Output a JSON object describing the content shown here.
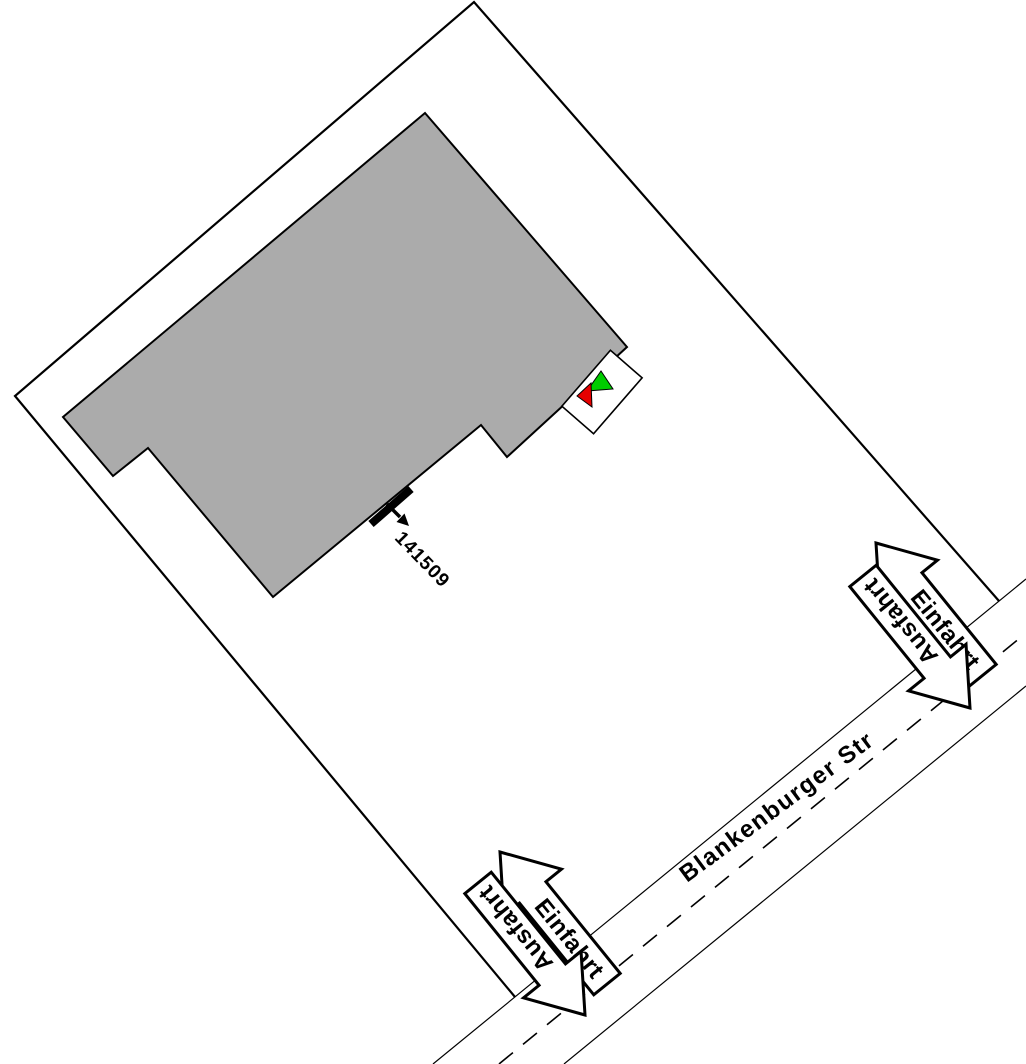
{
  "plan": {
    "street_name": "Blankenburger Str",
    "marker_id": "141509",
    "driveway_north": {
      "entry_label": "Einfahrt",
      "exit_label": "Ausfahrt"
    },
    "driveway_south": {
      "entry_label": "Einfahrt",
      "exit_label": "Ausfahrt"
    },
    "colors": {
      "background": "#ffffff",
      "outline": "#000000",
      "building_fill": "#ababab",
      "entry_green": "#00cc00",
      "exit_red": "#e60000"
    }
  }
}
